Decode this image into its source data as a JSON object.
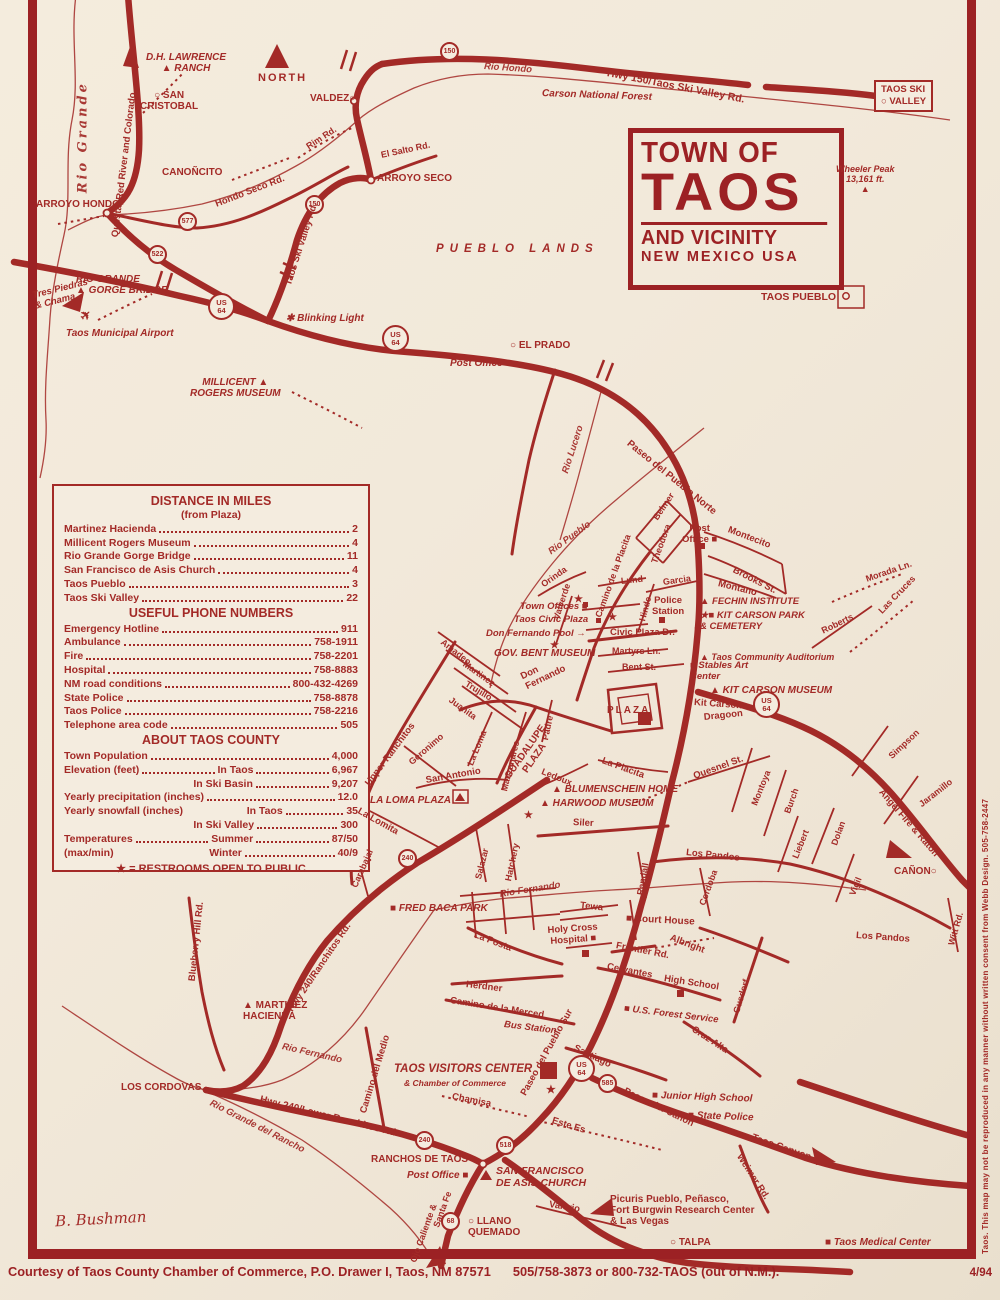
{
  "map_title": {
    "line1": "TOWN OF",
    "line2": "TAOS",
    "line3": "AND VICINITY",
    "line4": "NEW MEXICO USA"
  },
  "colors": {
    "ink_red": "#a32a27",
    "paper_cream": "#f4ecdf"
  },
  "info_box": {
    "s1_heading": "DISTANCE IN MILES",
    "s1_sub": "(from Plaza)",
    "s1_rows": [
      [
        "Martinez Hacienda",
        "2"
      ],
      [
        "Millicent Rogers Museum",
        "4"
      ],
      [
        "Rio Grande Gorge Bridge",
        "11"
      ],
      [
        "San Francisco de Asis Church",
        "4"
      ],
      [
        "Taos Pueblo",
        "3"
      ],
      [
        "Taos Ski Valley",
        "22"
      ]
    ],
    "s2_heading": "USEFUL PHONE NUMBERS",
    "s2_rows": [
      [
        "Emergency Hotline",
        "911"
      ],
      [
        "Ambulance",
        "758-1911"
      ],
      [
        "Fire",
        "758-2201"
      ],
      [
        "Hospital",
        "758-8883"
      ],
      [
        "NM road conditions",
        "800-432-4269"
      ],
      [
        "State Police",
        "758-8878"
      ],
      [
        "Taos Police",
        "758-2216"
      ],
      [
        "Telephone area code",
        "505"
      ]
    ],
    "s3_heading": "ABOUT TAOS COUNTY",
    "s3_rows": [
      {
        "label": "Town Population",
        "mid": "",
        "value": "4,000"
      },
      {
        "label": "Elevation (feet)",
        "mid": "In Taos",
        "value": "6,967"
      },
      {
        "label": "",
        "mid": "In Ski Basin",
        "value": "9,207"
      },
      {
        "label": "Yearly precipitation (inches)",
        "mid": "",
        "value": "12.0"
      },
      {
        "label": "Yearly snowfall (inches)",
        "mid": "In Taos",
        "value": "35"
      },
      {
        "label": "",
        "mid": "In Ski Valley",
        "value": "300"
      },
      {
        "label": "Temperatures",
        "mid": "Summer",
        "value": "87/50"
      },
      {
        "label": "(max/min)",
        "mid": "Winter",
        "value": "40/9"
      }
    ],
    "legend": "★ = RESTROOMS OPEN TO PUBLIC"
  },
  "footer": {
    "courtesy": "Courtesy of Taos County Chamber of Commerce, P.O. Drawer I, Taos, NM 87571",
    "phones": "505/758-3873 or 800-732-TAOS (out of N.M.).",
    "date": "4/94"
  },
  "side_credit": "Taos. This map may not be reproduced in any manner without written consent from Webb Design. 505-758-2447",
  "signature": "B. Bushman",
  "shields": [
    "150",
    "150",
    "577",
    "522",
    "US\n64",
    "US\n64",
    "US\n64",
    "US\n64",
    "585",
    "240",
    "240",
    "518",
    "68"
  ],
  "labels": [
    "Rio Grande",
    "Questa, Red River and Colorado",
    "D.H. LAWRENCE\n▲ RANCH",
    "○ SAN\nCRISTOBAL",
    "NORTH",
    "VALDEZ○",
    "Rim Rd.",
    "El Salto Rd.",
    "CANOÑCITO",
    "Hondo Seco Rd.",
    "ARROYO HONDO",
    "ARROYO SECO",
    "Rio Hondo",
    "Hwy 150/Taos Ski Valley Rd.",
    "Carson National Forest",
    "TAOS SKI\n○ VALLEY",
    "Taos Ski Valley Rd.",
    "Wheeler Peak\n13,161 ft.\n▲",
    "PUEBLO LANDS",
    "RIO GRANDE\n▲ GORGE BRIDGE",
    "Tres Piedras\n& Chama",
    "Taos Municipal Airport",
    "✱ Blinking Light",
    "TAOS PUEBLO",
    "○ EL PRADO",
    "Post Office ■",
    "MILLICENT ▲\nROGERS MUSEUM",
    "Rio Pueblo",
    "Rio Lucero",
    "Paseo del Pueblo Norte",
    "Belmer",
    "Theodora",
    "Camino de la Placita",
    "Orinda",
    "Valverde",
    "Lund",
    "Garcia",
    "Hinde",
    "Montecito",
    "Post\nOffice ■",
    "Brooks St.",
    "Montano",
    "Police\nStation",
    "▲ FECHIN INSTITUTE",
    "★■ KIT CARSON PARK\n& CEMETERY",
    "Roberts",
    "▲ Taos Community Auditorium",
    "Morada Ln.",
    "Las Cruces",
    "■ Stables Art\nCenter",
    "Martyrs Ln.",
    "Bent St.",
    "GOV. BENT MUSEUM",
    "Town Offices ■",
    "Taos Civic Plaza",
    "Don Fernando Pool →",
    "Civic Plaza Dr.",
    "▲ KIT CARSON MUSEUM",
    "Kit Carson",
    "Dragoon",
    "PLAZA",
    "Quesnel St.",
    "Montoya",
    "Burch",
    "Liebert",
    "Dolan",
    "Vigil",
    "Simpson",
    "Jaramillo",
    "Angel Fire & Raton",
    "CAÑON○",
    "Witt Rd.",
    "Los Pandos",
    "Los Pandos",
    "Cordoba",
    "Randall",
    "Siler",
    "Ledoux",
    "La Placita",
    "▲ BLUMENSCHEIN HOME",
    "▲ HARWOOD MUSEUM",
    "★",
    "GUADALUPE\nPLAZA",
    "Don\nFernando",
    "Padre",
    "Manzanares",
    "La Loma",
    "Juanita",
    "Trujillo",
    "Martinez",
    "Amadeo",
    "Upper Ranchitos",
    "Geronimo",
    "San Antonio",
    "LA LOMA PLAZA",
    "La Lomita",
    "Carabajal",
    "Salazar",
    "Hatchery",
    "Rio Fernando",
    "■ FRED BACA PARK",
    "Tewa",
    "■ Court House",
    "La Posta",
    "Holy Cross\nHospital ■",
    "Frontier Rd.",
    "Albright",
    "Cervantes",
    "High School",
    "Gusdorf",
    "Herdner",
    "Camino de la Merced",
    "Bus Station",
    "■ U.S. Forest Service",
    "Cruz Alta",
    "Paseo del Pueblo Sur",
    "Santiago",
    "TAOS VISITORS CENTER",
    "& Chamber of Commerce",
    "Chamisa",
    "Este Es",
    "■ Junior High School",
    "■ State Police",
    "Paseo del Canon",
    "Taos Canyon",
    "Weimer Rd.",
    "Picuris Pueblo, Peñasco,\nFort Burgwin Research Center\n& Las Vegas",
    "○ TALPA",
    "■ Taos Medical Center",
    "RANCHOS DE TAOS",
    "Post Office ■",
    "SAN FRANCISCO\nDE ASIS CHURCH",
    "Valerio",
    "○ LLANO\nQUEMADO",
    "Ojo Caliente &",
    "Santa Fe",
    "Camino del Medio",
    "Hwy 240/Ranchitos Rd.",
    "Blueberry Hill Rd.",
    "▲ MARTINEZ\nHACIENDA",
    "Rio Fernando",
    "LOS CORDOVAS",
    "Rio Grande del Rancho",
    "Hwy 240/Lower Ranchitos Rd.",
    "★",
    "★",
    "★",
    "★",
    "✈"
  ]
}
